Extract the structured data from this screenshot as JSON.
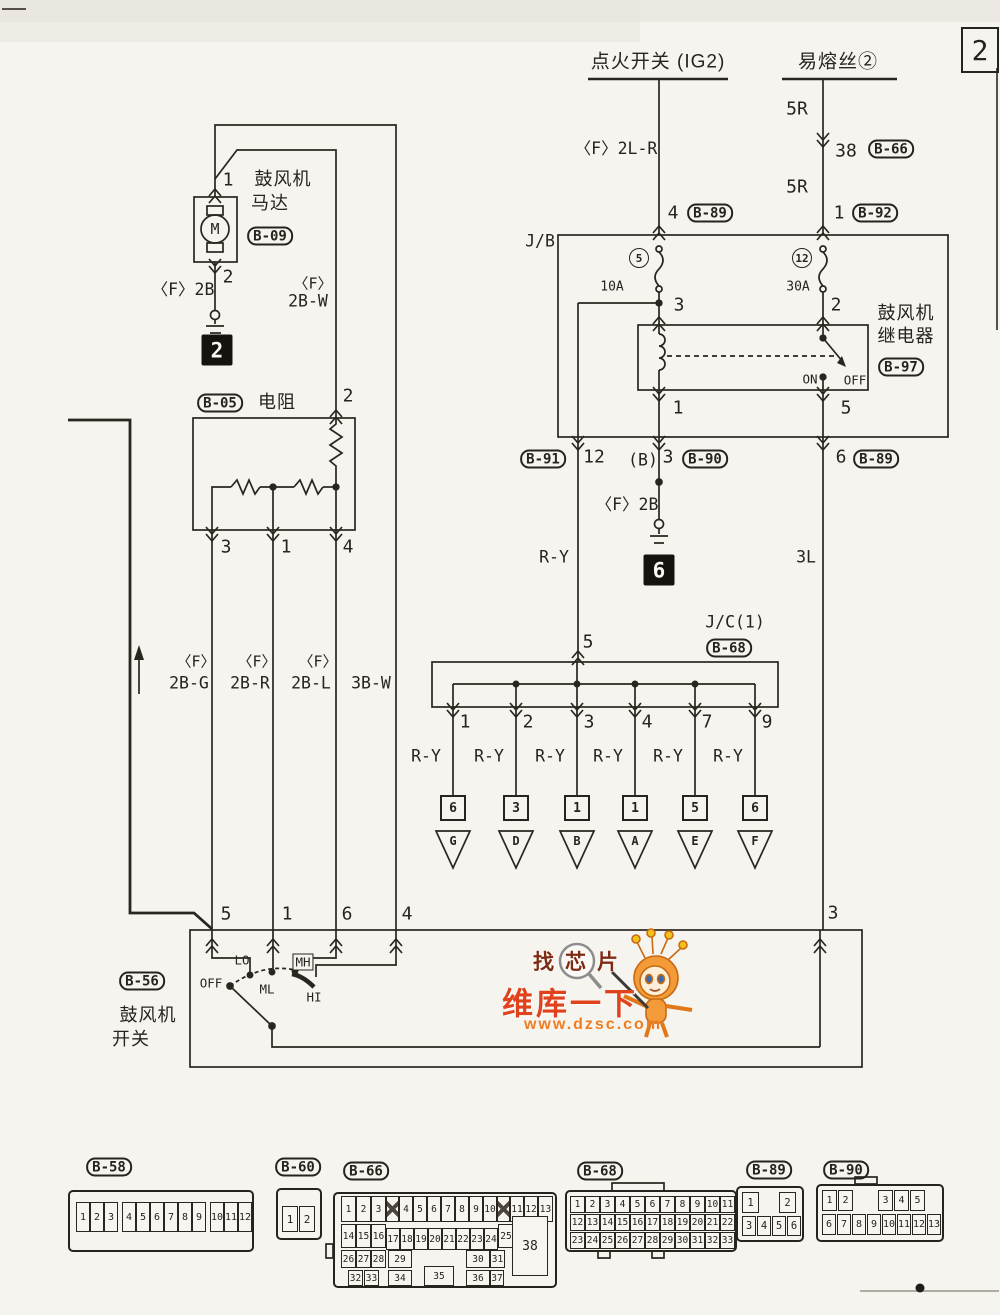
{
  "page": {
    "sheet_number": "2"
  },
  "header": {
    "ignition_switch": "点火开关 (IG2)",
    "fusible_link": "易熔丝②",
    "wire_2lr": "〈F〉2L-R",
    "wire_5r_upper": "5R",
    "wire_5r_lower": "5R",
    "pin_38": "38",
    "conn_b66": "B-66",
    "pin_4": "4",
    "conn_b89": "B-89",
    "pin_1": "1",
    "conn_b92": "B-92"
  },
  "motor": {
    "pin_top": "1",
    "name_line1": "鼓风机",
    "name_line2": "马达",
    "connector": "B-09",
    "symbol": "M",
    "pin_bottom": "2",
    "wire_ground": "〈F〉2B",
    "ground_ref": "2",
    "wire_f": "〈F〉",
    "wire_2bw": "2B-W"
  },
  "junction_block": {
    "label": "J/B",
    "fuse_left_no": "5",
    "fuse_left_amp": "10A",
    "fuse_right_no": "12",
    "fuse_right_amp": "30A",
    "pin_3": "3",
    "pin_2": "2",
    "pin_1": "1",
    "pin_5": "5",
    "relay_name_line1": "鼓风机",
    "relay_name_line2": "继电器",
    "relay_connector": "B-97",
    "relay_on": "ON",
    "relay_off": "OFF",
    "out_left_connector": "B-91",
    "out_left_pin": "12",
    "out_mid_prefix": "(B)",
    "out_mid_pin": "3",
    "out_mid_connector": "B-90",
    "out_right_pin": "6",
    "out_right_connector": "B-89"
  },
  "middle": {
    "wire_ry": "R-Y",
    "wire_ground": "〈F〉2B",
    "ground_ref": "6",
    "wire_3l": "3L",
    "jc_title": "J/C(1)",
    "jc_connector": "B-68",
    "jc_pin_in": "5",
    "branch_pins": [
      "1",
      "2",
      "3",
      "4",
      "7",
      "9"
    ],
    "branch_wire": "R-Y",
    "branch_terms": [
      "6",
      "3",
      "1",
      "1",
      "5",
      "6"
    ],
    "branch_dests": [
      "G",
      "D",
      "B",
      "A",
      "E",
      "F"
    ]
  },
  "resistor": {
    "connector": "B-05",
    "name": "电阻",
    "pin_top": "2",
    "pin_bottom_1": "3",
    "pin_bottom_2": "1",
    "pin_bottom_3": "4"
  },
  "wire_labels": {
    "f1": "〈F〉",
    "w1": "2B-G",
    "f2": "〈F〉",
    "w2": "2B-R",
    "f3": "〈F〉",
    "w3": "2B-L",
    "w4": "3B-W"
  },
  "blower_switch": {
    "connector": "B-56",
    "name_line1": "鼓风机",
    "name_line2": "开关",
    "pin_5": "5",
    "pin_1": "1",
    "pin_6": "6",
    "pin_4": "4",
    "pin_3": "3",
    "pos_off": "OFF",
    "pos_lo": "LO",
    "pos_ml": "ML",
    "pos_mh": "MH",
    "pos_hi": "HI"
  },
  "watermark": {
    "line1": "找芯片",
    "line2": "维库一下",
    "url": "www.dzsc.com",
    "color_primary": "#e0431c",
    "color_secondary": "#ef7d22"
  },
  "connectors": {
    "b58": {
      "id": "B-58",
      "pins": [
        "1",
        "2",
        "3",
        "4",
        "5",
        "6",
        "7",
        "8",
        "9",
        "10",
        "11",
        "12"
      ]
    },
    "b60": {
      "id": "B-60",
      "pins": [
        "1",
        "2"
      ]
    },
    "b66": {
      "id": "B-66",
      "pins": [
        "1",
        "2",
        "3",
        "4",
        "5",
        "6",
        "7",
        "8",
        "9",
        "10",
        "11",
        "12",
        "13",
        "14",
        "15",
        "16",
        "17",
        "18",
        "19",
        "20",
        "21",
        "22",
        "23",
        "24",
        "25",
        "26",
        "27",
        "28",
        "29",
        "30",
        "31",
        "32",
        "33",
        "34",
        "35",
        "36",
        "37",
        "38"
      ]
    },
    "b68": {
      "id": "B-68",
      "pins": [
        "1",
        "2",
        "3",
        "4",
        "5",
        "6",
        "7",
        "8",
        "9",
        "10",
        "11",
        "12",
        "13",
        "14",
        "15",
        "16",
        "17",
        "18",
        "19",
        "20",
        "21",
        "22",
        "23",
        "24",
        "25",
        "26",
        "27",
        "28",
        "29",
        "30",
        "31",
        "32",
        "33"
      ]
    },
    "b89": {
      "id": "B-89",
      "pins": [
        "1",
        "2",
        "3",
        "4",
        "5",
        "6"
      ]
    },
    "b90": {
      "id": "B-90",
      "pins": [
        "1",
        "2",
        "3",
        "4",
        "5",
        "6",
        "7",
        "8",
        "9",
        "10",
        "11",
        "12",
        "13"
      ]
    }
  }
}
